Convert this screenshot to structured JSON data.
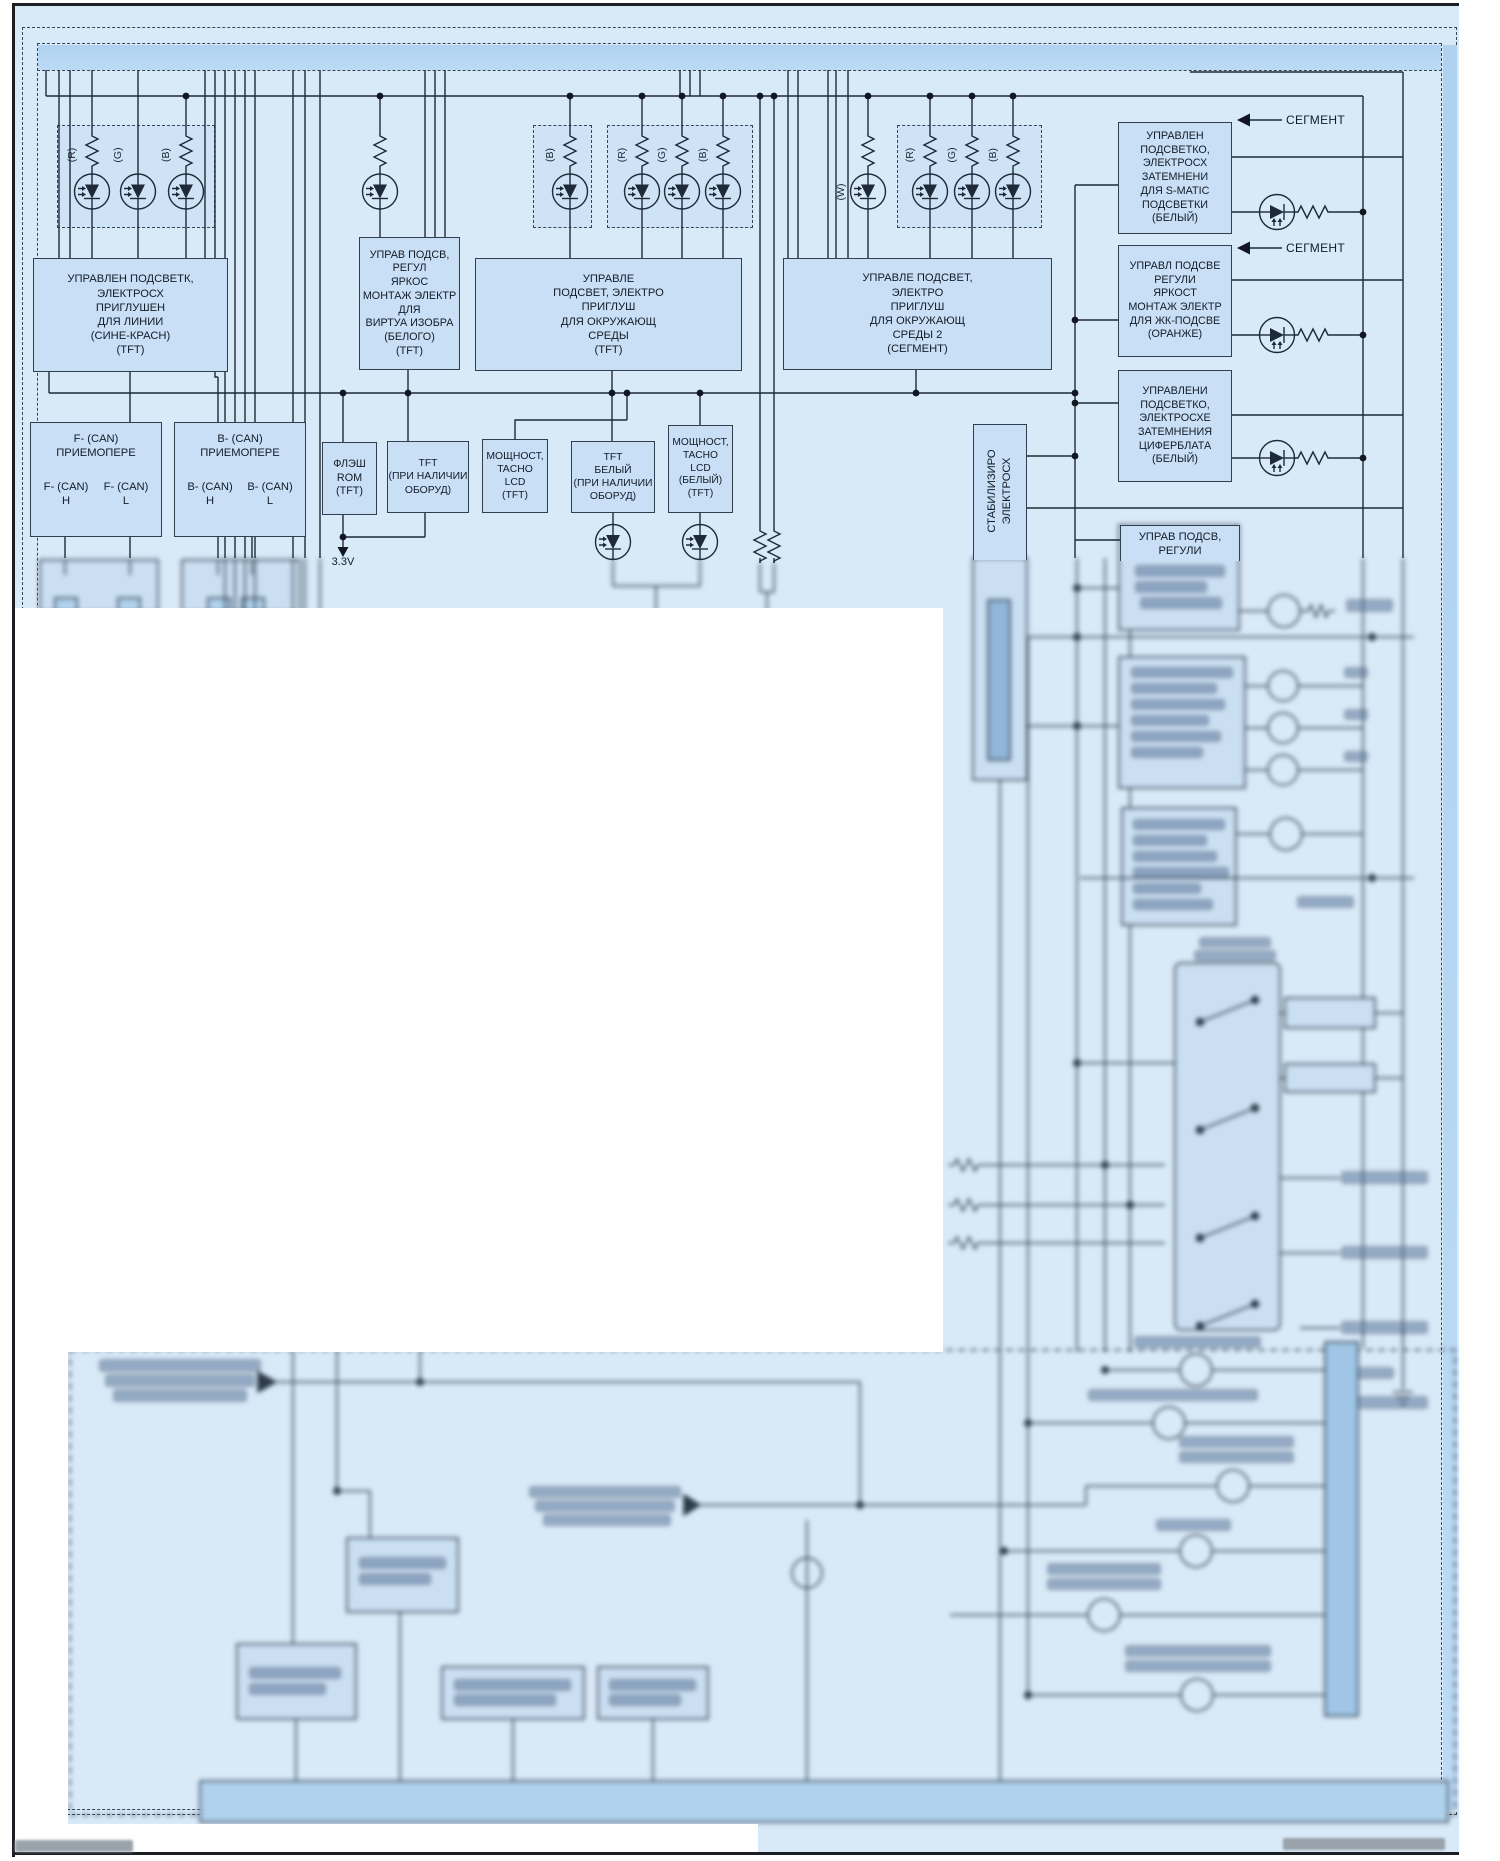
{
  "diagram": {
    "labels": {
      "segment": "СЕГМЕНТ",
      "voltage_3v3": "3.3V",
      "led_r": "(R)",
      "led_g": "(G)",
      "led_b": "(B)",
      "led_w": "(W)"
    },
    "boxes": {
      "tft_line_dimmer": "УПРАВЛЕН ПОДСВЕТК,\nЭЛЕКТРОСХ\nПРИГЛУШЕН\nДЛЯ ЛИНИИ\n(СИНЕ-КРАСН)\n(TFT)",
      "virtual_image_brightness": "УПРАВ ПОДСВ,\nРЕГУЛ\nЯРКОС\nМОНТАЖ ЭЛЕКТР\nДЛЯ\nВИРТУА ИЗОБРА\n(БЕЛОГО)\n(TFT)",
      "ambient_dimmer_tft": "УПРАВЛЕ\nПОДСВЕТ, ЭЛЕКТРО\nПРИГЛУШ\nДЛЯ ОКРУЖАЮЩ\nСРЕДЫ\n(TFT)",
      "ambient_dimmer_segment": "УПРАВЛЕ ПОДСВЕТ,\nЭЛЕКТРО\nПРИГЛУШ\nДЛЯ ОКРУЖАЮЩ\nСРЕДЫ 2\n(СЕГМЕНТ)",
      "smatic_backlight": "УПРАВЛЕН\nПОДСВЕТКО,\nЭЛЕКТРОСХ\nЗАТЕМНЕНИ\nДЛЯ S-MATIC\nПОДСВЕТКИ\n(БЕЛЫЙ)",
      "lcd_backlight_orange": "УПРАВЛ ПОДСВЕ\nРЕГУЛИ\nЯРКОСТ\nМОНТАЖ ЭЛЕКТР\nДЛЯ ЖК-ПОДСВЕ\n(ОРАНЖЕ)",
      "dial_dimming": "УПРАВЛЕНИ\nПОДСВЕТКО,\nЭЛЕКТРОСХЕ\nЗАТЕМНЕНИЯ\nЦИФЕРБЛАТА\n(БЕЛЫЙ)",
      "backlight_regulator_partial": "УПРАВ ПОДСВ,\nРЕГУЛИ",
      "stabilizer": "СТАБИЛИЗИРО\nЭЛЕКТРОСХ",
      "flash_rom": "ФЛЭШ\nROM\n(TFT)",
      "tft_if_equipped": "TFT\n(ПРИ НАЛИЧИИ\nОБОРУД)",
      "power_tacho_lcd_tft": "МОЩНОСТ,\nTACHO\nLCD\n(TFT)",
      "tft_white_if_equipped": "TFT\nБЕЛЫЙ\n(ПРИ НАЛИЧИИ\nОБОРУД)",
      "power_tacho_lcd_white": "МОЩНОСТ,\nTACHO\nLCD\n(БЕЛЫЙ)\n(TFT)",
      "f_can": {
        "title": "F- (CAN)\nПРИЕМОПЕРЕ",
        "pin_h": "F- (CAN)\nH",
        "pin_l": "F- (CAN)\nL"
      },
      "b_can": {
        "title": "B- (CAN)\nПРИЕМОПЕРЕ",
        "pin_h": "B- (CAN)\nH",
        "pin_l": "B- (CAN)\nL"
      }
    }
  }
}
